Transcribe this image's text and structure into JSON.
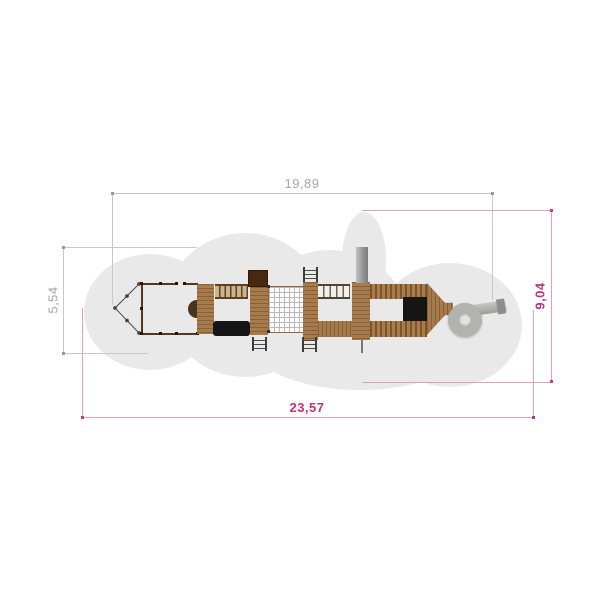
{
  "drawing": {
    "type": "playground-equipment-top-view-plan",
    "dimensions": {
      "top": {
        "label": "19,89"
      },
      "left": {
        "label": "5,54"
      },
      "right": {
        "label": "9,04"
      },
      "bottom": {
        "label": "23,57"
      }
    },
    "colors": {
      "background": "#ffffff",
      "safety_zone": "#e9e9e9",
      "dim_gray_line": "#c8c8c8",
      "dim_gray_text": "#a6a6a6",
      "dim_pink_line": "#e59cc4",
      "dim_pink_text": "#c03277",
      "wood_mid": "#a57a4c",
      "wood_dark": "#7d5528",
      "roof_dark_brown": "#46290f",
      "tunnel_black": "#151515",
      "mast_gray": "#9c9c9c",
      "slide_gray": "#b2b2ae",
      "bow_line": "#4a4a4a"
    },
    "components": [
      "safety-zone",
      "ship-bow",
      "deck-frame",
      "bow-platform",
      "monkey-bars",
      "crawl-tunnel",
      "tower-roof",
      "climbing-net",
      "ladder",
      "rope-bridge",
      "mast",
      "flag-pole",
      "stairs-upper",
      "stairs-lower",
      "bridge-ramp",
      "tunnel-entrance",
      "stern-platform",
      "spiral-slide"
    ]
  }
}
